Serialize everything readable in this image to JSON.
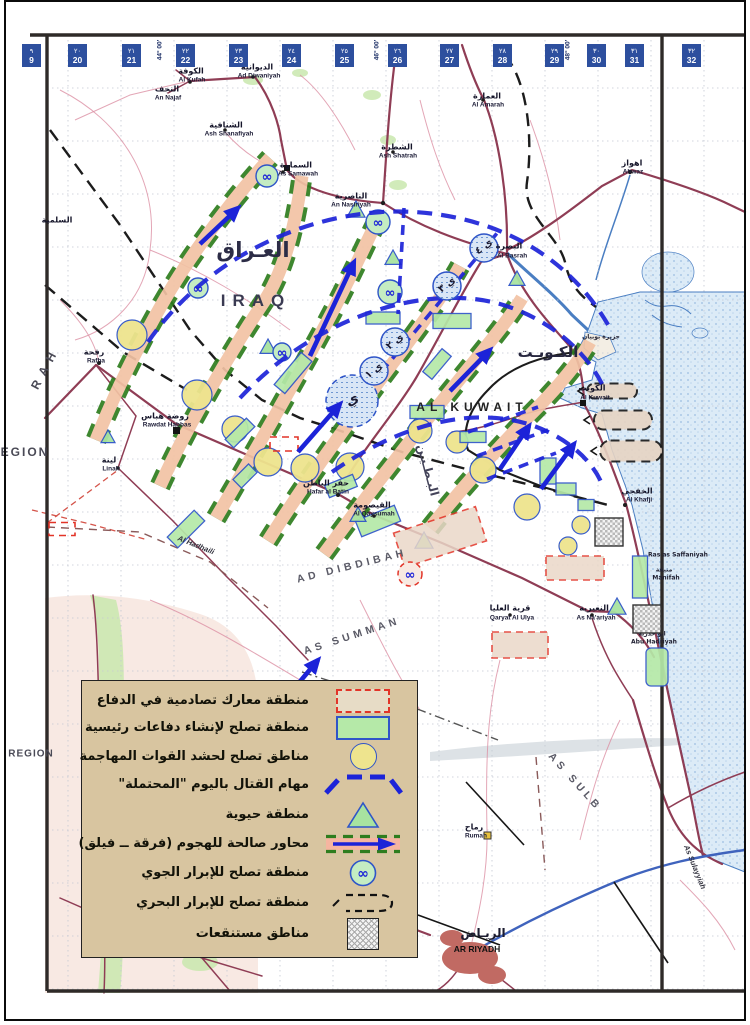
{
  "colors": {
    "overlay-blue": "#1c23d8",
    "dash-green": "#2e7d1e",
    "corridor-tan": "#f2c3a4",
    "salmon": "#f5b5a0",
    "circle-yellow": "#eee48e",
    "sym-blue": "#2f55c8",
    "rect-green": "#b5e9a8",
    "tri-green": "#a8e3a0",
    "red-dash": "#e23428",
    "road": "#8f3d55",
    "road-minor": "#dc90a4",
    "highway": "#3f63bd",
    "water-line": "#4a7ec2",
    "water-fill": "#d7e7f5",
    "legend-bg": "#d8c5a0",
    "grid-box": "#2d4f9e",
    "veg": "#c9e7ae",
    "pink-terrain": "#f6e4dc",
    "urban": "#c16a63",
    "neat": "#2e2a28"
  },
  "icons": {
    "air_landing_glyph": "∞"
  },
  "grid_columns": [
    {
      "ar": "٩",
      "en": "9",
      "x": 22
    },
    {
      "ar": "٢٠",
      "en": "20",
      "x": 68
    },
    {
      "ar": "٢١",
      "en": "21",
      "x": 122
    },
    {
      "ar": "٢٢",
      "en": "22",
      "x": 176
    },
    {
      "ar": "٢٣",
      "en": "23",
      "x": 229
    },
    {
      "ar": "٢٤",
      "en": "24",
      "x": 282
    },
    {
      "ar": "٢٥",
      "en": "25",
      "x": 335
    },
    {
      "ar": "٢٦",
      "en": "26",
      "x": 388
    },
    {
      "ar": "٢٧",
      "en": "27",
      "x": 440
    },
    {
      "ar": "٢٨",
      "en": "28",
      "x": 493
    },
    {
      "ar": "٢٩",
      "en": "29",
      "x": 545
    },
    {
      "ar": "٣٠",
      "en": "30",
      "x": 587
    },
    {
      "ar": "٣١",
      "en": "31",
      "x": 625
    },
    {
      "ar": "٣٢",
      "en": "32",
      "x": 682
    }
  ],
  "map_labels": [
    {
      "name": "iraq-ar",
      "t": "العـراق",
      "x": 253,
      "y": 250,
      "c": "xl-ar"
    },
    {
      "name": "iraq-en",
      "t": "IRAQ",
      "x": 256,
      "y": 301,
      "c": "xl-en"
    },
    {
      "name": "kuwait-country-ar",
      "t": "الكـويـت",
      "x": 548,
      "y": 352,
      "c": "lg-ar"
    },
    {
      "name": "kuwait-country-en",
      "t": "AL KUWAIT",
      "x": 472,
      "y": 407,
      "c": "lg-en"
    },
    {
      "name": "kuwait-city-ar",
      "t": "الكويت",
      "x": 592,
      "y": 388,
      "c": "town-ar"
    },
    {
      "name": "kuwait-city-en",
      "t": "Al Kuwait",
      "x": 595,
      "y": 398,
      "c": "town-en"
    },
    {
      "name": "basrah-ar",
      "t": "البصرة",
      "x": 509,
      "y": 246,
      "c": "town-ar"
    },
    {
      "name": "basrah-en",
      "t": "Al Basrah",
      "x": 512,
      "y": 256,
      "c": "town-en"
    },
    {
      "name": "kufah-ar",
      "t": "الكوفة",
      "x": 191,
      "y": 71,
      "c": "town-ar"
    },
    {
      "name": "kufah-en",
      "t": "Al Kufah",
      "x": 192,
      "y": 80,
      "c": "town-en"
    },
    {
      "name": "diwaniyah-ar",
      "t": "الديوانية",
      "x": 257,
      "y": 67,
      "c": "town-ar"
    },
    {
      "name": "diwaniyah-en",
      "t": "Ad Diwaniyah",
      "x": 259,
      "y": 76,
      "c": "town-en"
    },
    {
      "name": "najaf-ar",
      "t": "النجف",
      "x": 167,
      "y": 89,
      "c": "town-ar"
    },
    {
      "name": "najaf-en",
      "t": "An Najaf",
      "x": 168,
      "y": 98,
      "c": "town-en"
    },
    {
      "name": "shanafiyah-ar",
      "t": "الشنافية",
      "x": 226,
      "y": 125,
      "c": "town-ar"
    },
    {
      "name": "shanafiyah-en",
      "t": "Ash Shanafiyah",
      "x": 229,
      "y": 134,
      "c": "town-en"
    },
    {
      "name": "samawah-ar",
      "t": "السماوة",
      "x": 296,
      "y": 165,
      "c": "town-ar"
    },
    {
      "name": "samawah-en",
      "t": "As Samawah",
      "x": 298,
      "y": 174,
      "c": "town-en"
    },
    {
      "name": "shatrah-ar",
      "t": "الشطرة",
      "x": 397,
      "y": 147,
      "c": "town-ar"
    },
    {
      "name": "shatrah-en",
      "t": "Ash Shatrah",
      "x": 398,
      "y": 156,
      "c": "town-en"
    },
    {
      "name": "amarah-ar",
      "t": "العمارة",
      "x": 487,
      "y": 96,
      "c": "town-ar"
    },
    {
      "name": "amarah-en",
      "t": "Al Amarah",
      "x": 488,
      "y": 105,
      "c": "town-en"
    },
    {
      "name": "nasiriyah-ar",
      "t": "الناصرية",
      "x": 351,
      "y": 196,
      "c": "town-ar"
    },
    {
      "name": "nasiriyah-en",
      "t": "An Nasiriyah",
      "x": 351,
      "y": 205,
      "c": "town-en"
    },
    {
      "name": "ahwaz-ar",
      "t": "اهواز",
      "x": 632,
      "y": 163,
      "c": "town-ar"
    },
    {
      "name": "ahwaz-en",
      "t": "Ahwaz",
      "x": 633,
      "y": 172,
      "c": "town-en"
    },
    {
      "name": "rafha-ar",
      "t": "رفحة",
      "x": 94,
      "y": 352,
      "c": "town-ar"
    },
    {
      "name": "rafha-en",
      "t": "Rafha",
      "x": 96,
      "y": 361,
      "c": "town-en"
    },
    {
      "name": "hafar-ar",
      "t": "حفر الباطن",
      "x": 326,
      "y": 483,
      "c": "town-ar"
    },
    {
      "name": "hafar-en",
      "t": "Hafar al Batin",
      "x": 328,
      "y": 492,
      "c": "town-en"
    },
    {
      "name": "qaysumah-ar",
      "t": "القيصومة",
      "x": 372,
      "y": 505,
      "c": "town-ar"
    },
    {
      "name": "qaysumah-en",
      "t": "Al Qaysumah",
      "x": 374,
      "y": 514,
      "c": "town-en"
    },
    {
      "name": "khafji-ar",
      "t": "الخفجي",
      "x": 637,
      "y": 491,
      "c": "town-ar"
    },
    {
      "name": "khafji-en",
      "t": "Al Khafji",
      "x": 639,
      "y": 500,
      "c": "town-en"
    },
    {
      "name": "nuayriyah-ar",
      "t": "النعيرية",
      "x": 594,
      "y": 608,
      "c": "town-ar"
    },
    {
      "name": "nuayriyah-en",
      "t": "As Na'ariyah",
      "x": 596,
      "y": 618,
      "c": "town-en"
    },
    {
      "name": "qaryat-ar",
      "t": "قرية العليا",
      "x": 510,
      "y": 608,
      "c": "town-ar"
    },
    {
      "name": "qaryat-en",
      "t": "Qaryat Al Ulya",
      "x": 512,
      "y": 618,
      "c": "town-en"
    },
    {
      "name": "rumah-ar",
      "t": "رماح",
      "x": 474,
      "y": 827,
      "c": "town-ar"
    },
    {
      "name": "rumah-en",
      "t": "Rumah",
      "x": 476,
      "y": 836,
      "c": "town-en"
    },
    {
      "name": "linah-ar",
      "t": "لينة",
      "x": 109,
      "y": 460,
      "c": "town-ar"
    },
    {
      "name": "linah-en",
      "t": "Linah",
      "x": 111,
      "y": 469,
      "c": "town-en"
    },
    {
      "name": "rawdat-ar",
      "t": "روضة هباس",
      "x": 165,
      "y": 416,
      "c": "town-ar"
    },
    {
      "name": "rawdat-en",
      "t": "Rawdat Habbas",
      "x": 167,
      "y": 425,
      "c": "town-en"
    },
    {
      "name": "salmiyah-ar",
      "t": "السلمية",
      "x": 57,
      "y": 220,
      "c": "town-ar"
    },
    {
      "name": "riyadh-ar",
      "t": "الريـاض",
      "x": 483,
      "y": 933,
      "c": "city-ar"
    },
    {
      "name": "riyadh-en",
      "t": "AR RIYADH",
      "x": 477,
      "y": 949,
      "c": "city-en"
    },
    {
      "name": "region-upper",
      "t": "EGION",
      "x": 25,
      "y": 452,
      "c": "region"
    },
    {
      "name": "region-lower",
      "t": "REGION",
      "x": 31,
      "y": 754,
      "c": "region-sm"
    },
    {
      "name": "rah",
      "t": "R A H",
      "x": 44,
      "y": 370,
      "c": "region",
      "r": -62
    },
    {
      "name": "dibdibah",
      "t": "AD DIBDIBAH",
      "x": 352,
      "y": 566,
      "c": "phys",
      "r": -14
    },
    {
      "name": "summan",
      "t": "AS SUMMAN",
      "x": 352,
      "y": 636,
      "c": "phys",
      "r": -18
    },
    {
      "name": "sulb",
      "t": "AS SULB",
      "x": 575,
      "y": 782,
      "c": "phys",
      "r": 48
    },
    {
      "name": "urumah",
      "t": "Al Urumah",
      "x": 404,
      "y": 861,
      "c": "phys-sm",
      "r": -52
    },
    {
      "name": "sulayyilah",
      "t": "As Sulayyiah",
      "x": 695,
      "y": 867,
      "c": "phys-sm",
      "r": 68
    },
    {
      "name": "hadhaili",
      "t": "Al Hadhaili",
      "x": 196,
      "y": 545,
      "c": "phys-sm",
      "r": 22
    },
    {
      "name": "batin",
      "t": "البـطـيـن",
      "x": 428,
      "y": 470,
      "c": "wadi",
      "r": 75
    },
    {
      "name": "bubiyan",
      "t": "جزيرة بوبيان",
      "x": 601,
      "y": 337,
      "c": "coast"
    },
    {
      "name": "saffaniyah",
      "t": "Ras as Saffaniyah",
      "x": 678,
      "y": 555,
      "c": "coast"
    },
    {
      "name": "manifah-ar",
      "t": "منيفة",
      "x": 664,
      "y": 570,
      "c": "coast"
    },
    {
      "name": "manifah-en",
      "t": "Manifah",
      "x": 666,
      "y": 578,
      "c": "coast"
    },
    {
      "name": "abuhadriyah-ar",
      "t": "ابو حدرية",
      "x": 652,
      "y": 634,
      "c": "coast"
    },
    {
      "name": "abuhadriyah-en",
      "t": "Abu Hadriyah",
      "x": 654,
      "y": 642,
      "c": "coast"
    },
    {
      "name": "objective-y",
      "t": "ي",
      "x": 352,
      "y": 400,
      "c": "obj",
      "r": -30
    },
    {
      "name": "objective-y1",
      "t": "ي ١",
      "x": 374,
      "y": 371,
      "c": "obj-sm",
      "r": -38
    },
    {
      "name": "objective-y2",
      "t": "ي ٢",
      "x": 395,
      "y": 342,
      "c": "obj-sm",
      "r": -38
    },
    {
      "name": "objective-y3",
      "t": "ي ٣",
      "x": 447,
      "y": 285,
      "c": "obj-sm",
      "r": -38
    },
    {
      "name": "objective-y4",
      "t": "ي ٤",
      "x": 484,
      "y": 247,
      "c": "obj-sm",
      "r": -38
    },
    {
      "name": "lon-44",
      "t": "44° 00′",
      "x": 160,
      "y": 50,
      "c": "lon",
      "r": -90
    },
    {
      "name": "lon-46",
      "t": "46° 00′",
      "x": 377,
      "y": 50,
      "c": "lon",
      "r": -90
    },
    {
      "name": "lon-48",
      "t": "48° 00′",
      "x": 568,
      "y": 50,
      "c": "lon",
      "r": -90
    }
  ],
  "legend": {
    "items": [
      {
        "symbol": "red-dash-rect",
        "label": "منطقة معارك تصادمية في الدفاع"
      },
      {
        "symbol": "green-rect",
        "label": "منطقة تصلح لإنشاء دفاعات رئيسية"
      },
      {
        "symbol": "yellow-circle",
        "label": "مناطق تصلح لحشد القوات المهاجمة"
      },
      {
        "symbol": "blue-dash-arc",
        "label": "مهام القتال باليوم \"المحتملة\""
      },
      {
        "symbol": "green-triangle",
        "label": "منطقة حيوية"
      },
      {
        "symbol": "attack-axis",
        "label": "محاور صالحة للهجوم (فرقة ــ فيلق)"
      },
      {
        "symbol": "air-landing",
        "label": "منطقة تصلح للإبرار الجوي"
      },
      {
        "symbol": "naval-landing",
        "label": "منطقة تصلح للإبرار البحري"
      },
      {
        "symbol": "marsh",
        "label": "مناطق مستنقعات"
      }
    ]
  }
}
